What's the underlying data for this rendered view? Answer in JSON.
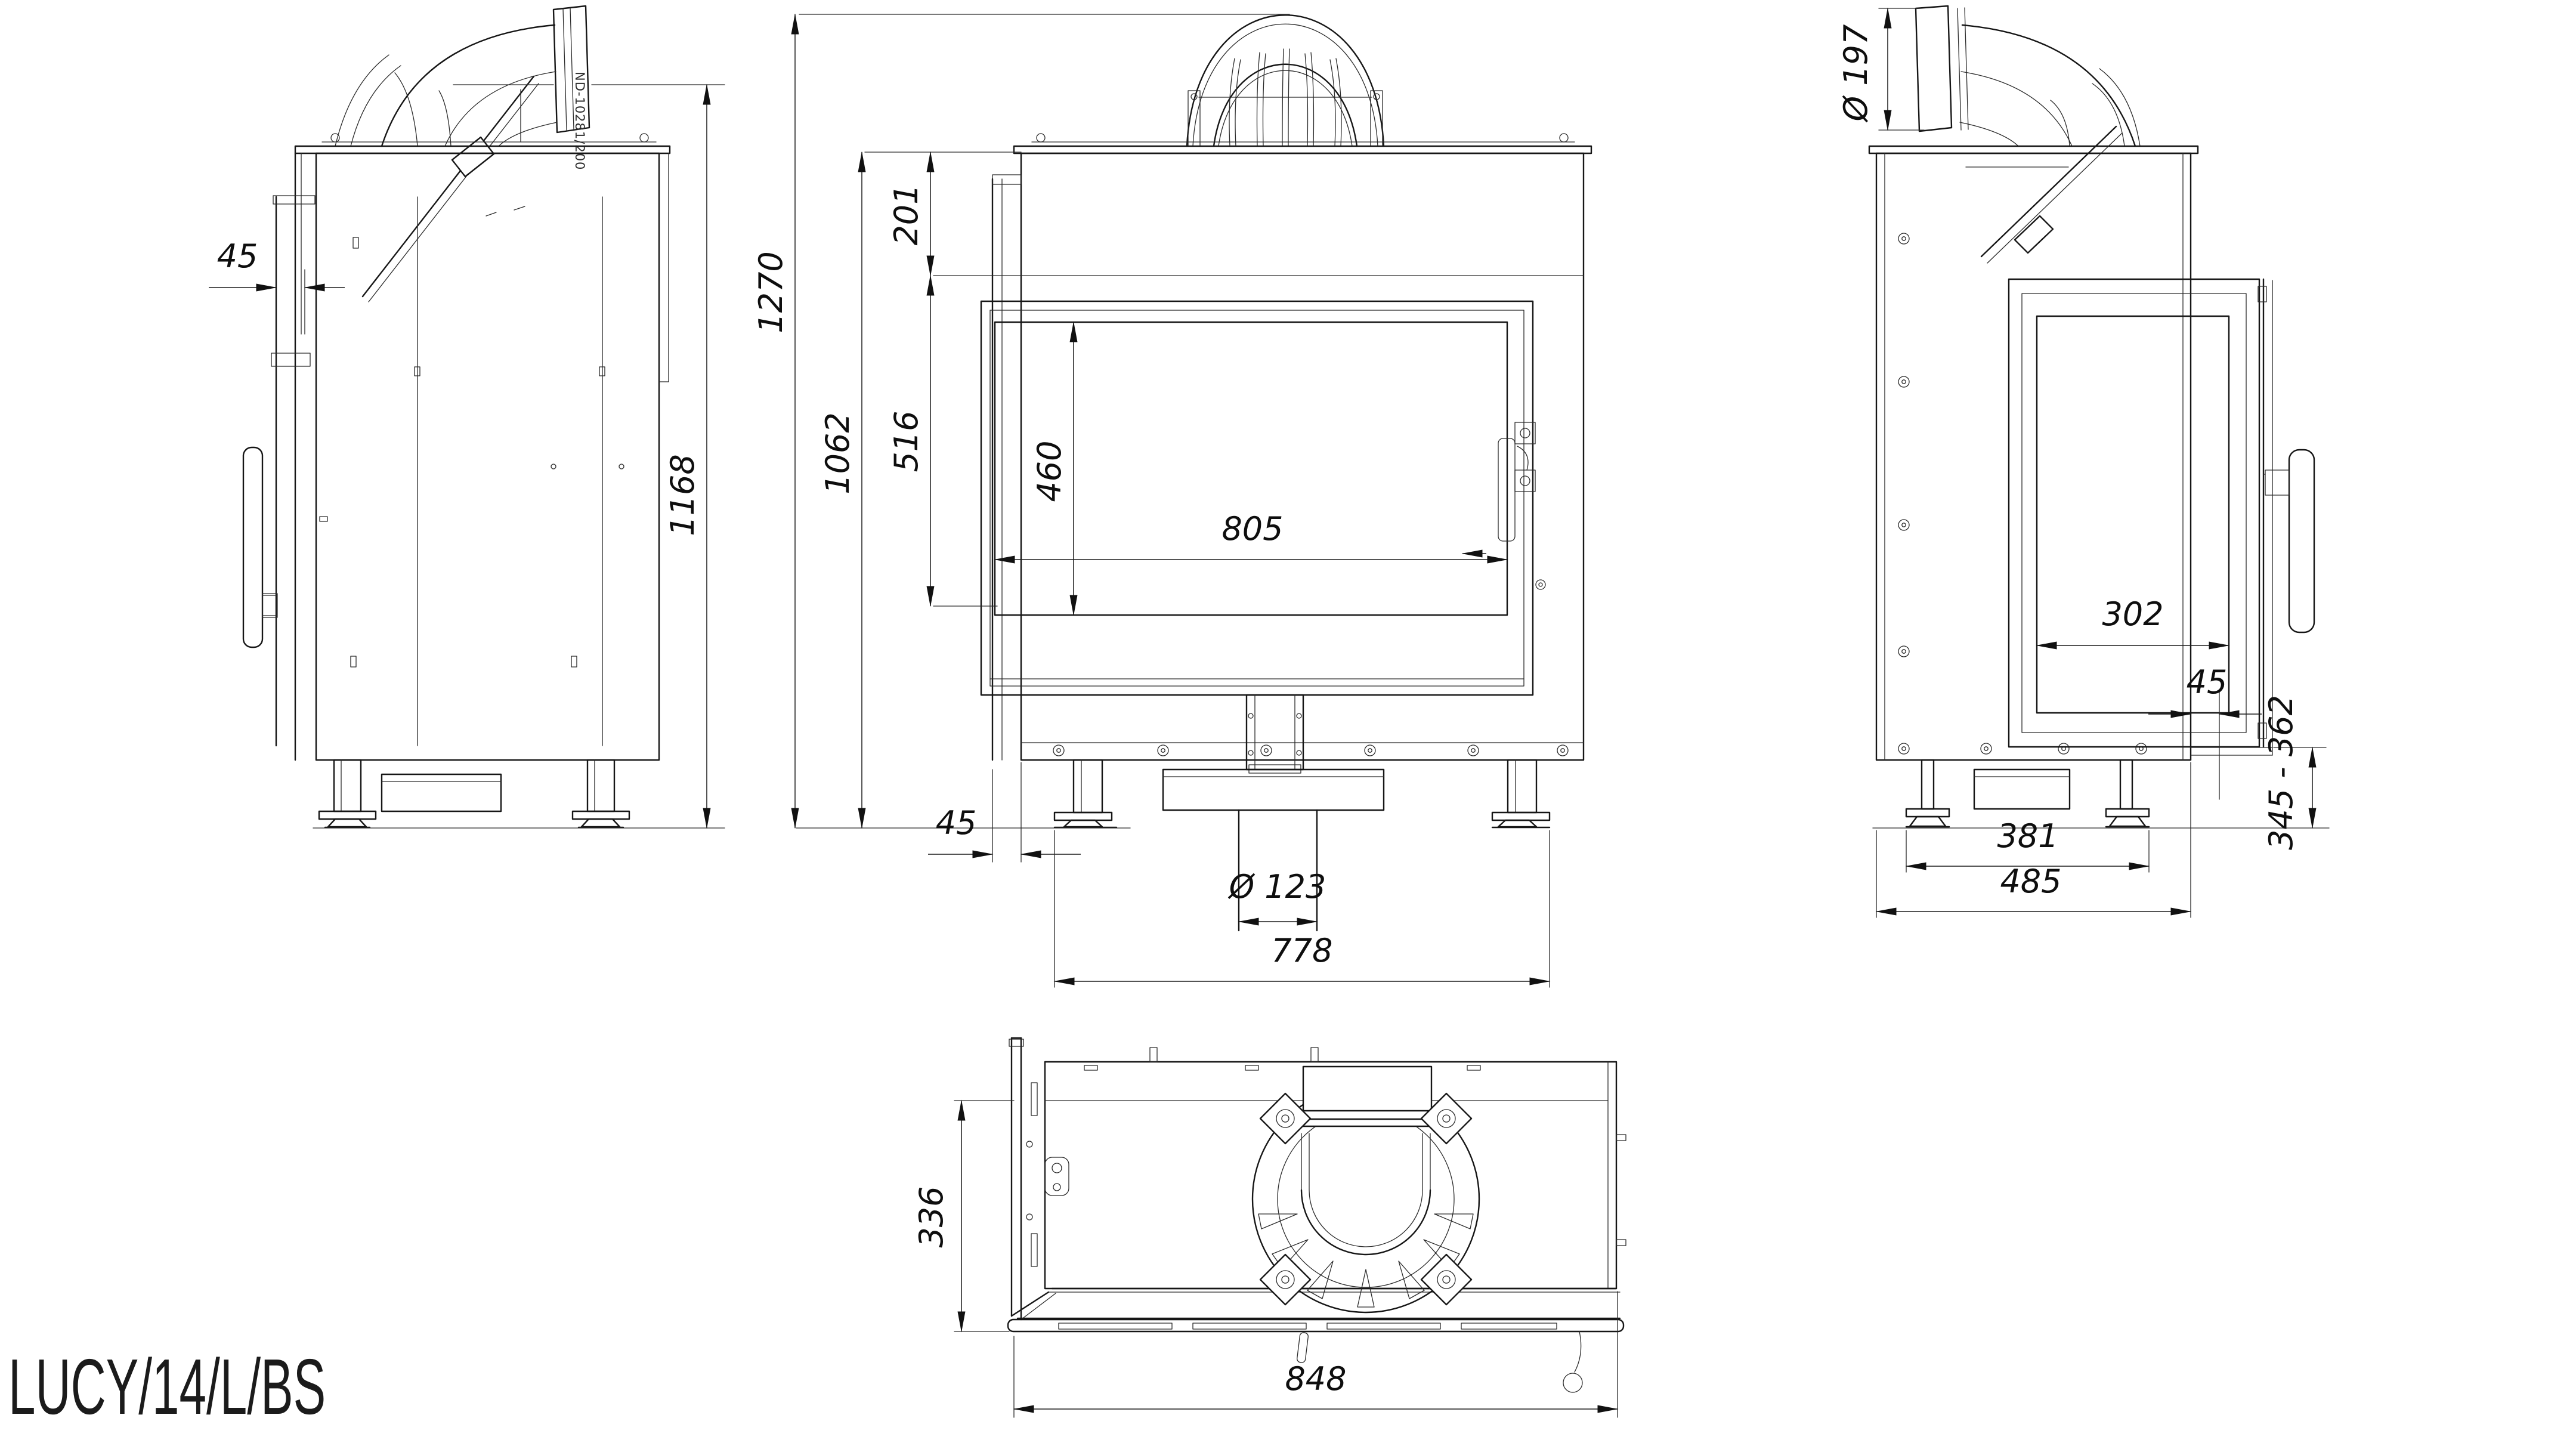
{
  "drawing": {
    "title": "LUCY/14/L/BS",
    "flue_part_label": "ND-10281/200",
    "views": {
      "left_side": {
        "dims": {
          "front_glass_offset": "45",
          "overall_height": "1168"
        }
      },
      "front": {
        "dims": {
          "height_to_flue_top": "1270",
          "body_height": "1062",
          "top_to_door": "201",
          "door_height": "516",
          "glass_height": "460",
          "glass_width": "805",
          "side_glass_offset": "45",
          "air_inlet_diameter": "Ø 123",
          "feet_spacing": "778"
        }
      },
      "right_side": {
        "dims": {
          "flue_outlet_diameter": "Ø 197",
          "side_glass_width": "302",
          "door_front_offset": "45",
          "base_height_range": "345 - 362",
          "feet_spacing": "381",
          "body_depth": "485"
        }
      },
      "top": {
        "dims": {
          "side_depth": "336",
          "overall_width": "848"
        }
      }
    }
  }
}
